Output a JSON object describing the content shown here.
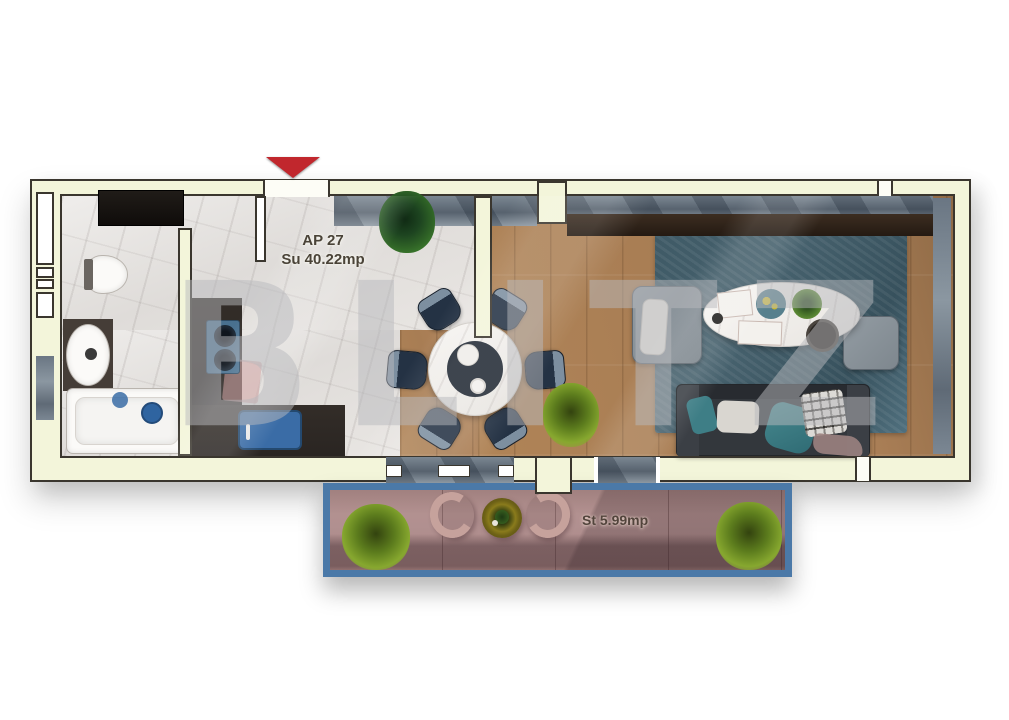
{
  "page": {
    "background": "#ffffff"
  },
  "plan": {
    "apartment_label": "AP 27",
    "apartment_area": "Su 40.22mp",
    "terrace_area": "St 5.99mp",
    "watermark": "BLITZ",
    "colors": {
      "page_bg": "#ffffff",
      "wall_fill": "#f3f5da",
      "wall_outline": "#3a362e",
      "marble_floor": "#e8e5e2",
      "wood_floor": "#a87d54",
      "rug_blue": "#46616d",
      "terrace_floor": "#b19090",
      "terrace_border": "#4b79a8",
      "entrance_arrow": "#c1272d",
      "label_text": "#4a4338",
      "sofa_dark": "#33373c",
      "dining_chair_navy": "#243244",
      "kitchen_counter": "#2a2522",
      "sink_blue": "#3a6ca6",
      "glass_gray": "#6a7683",
      "plant_dark_green": "#2f6326",
      "plant_yellow_green": "#87a82f",
      "watermark_gray": "#b9babe"
    }
  }
}
